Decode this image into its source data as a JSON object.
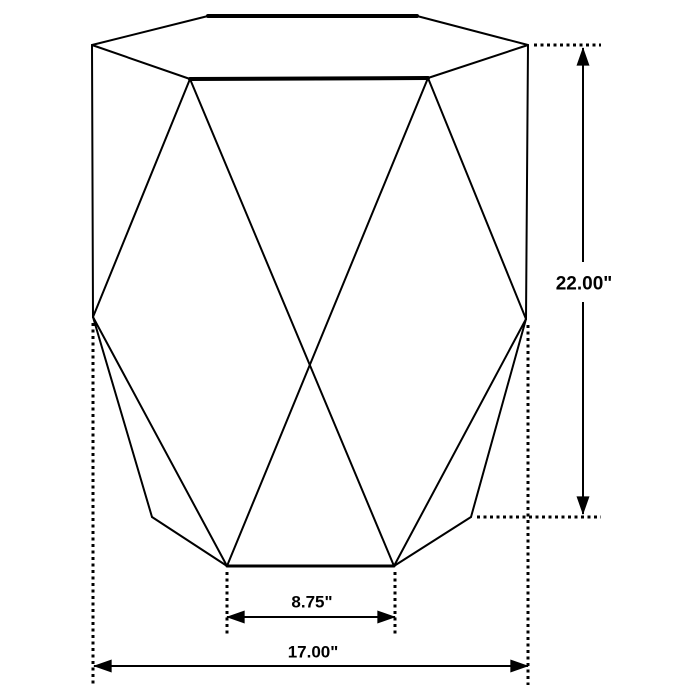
{
  "page": {
    "background": "#ffffff",
    "canvas": {
      "width": 700,
      "height": 700
    }
  },
  "diagram": {
    "description_name": "hexagonal-accent-table-dimension-drawing",
    "stroke_color": "#000000",
    "vertices": {
      "top_back_left": [
        208,
        16
      ],
      "top_back_right": [
        417,
        16
      ],
      "top_left": [
        92,
        45
      ],
      "top_right": [
        528,
        45
      ],
      "top_front_left": [
        190,
        79
      ],
      "top_front_right": [
        428,
        78
      ],
      "waist_left": [
        93,
        317
      ],
      "waist_right": [
        526,
        319
      ],
      "base_left": [
        152,
        517
      ],
      "base_right": [
        471,
        517
      ],
      "foot_left": [
        227,
        566
      ],
      "foot_right": [
        394,
        566
      ]
    },
    "edges": [
      {
        "name": "top-back-edge",
        "from": "top_back_left",
        "to": "top_back_right",
        "width": 4
      },
      {
        "name": "top-front-edge",
        "from": "top_front_left",
        "to": "top_front_right",
        "width": 4
      },
      {
        "name": "bottom-front-edge",
        "from": "foot_left",
        "to": "foot_right",
        "width": 3
      },
      {
        "name": "top-back-left-edge",
        "from": "top_back_left",
        "to": "top_left",
        "width": 2
      },
      {
        "name": "top-back-right-edge",
        "from": "top_back_right",
        "to": "top_right",
        "width": 2
      },
      {
        "name": "top-front-left-edge",
        "from": "top_left",
        "to": "top_front_left",
        "width": 2
      },
      {
        "name": "top-front-right-edge",
        "from": "top_right",
        "to": "top_front_right",
        "width": 2
      },
      {
        "name": "left-side-edge",
        "from": "top_left",
        "to": "waist_left",
        "width": 2
      },
      {
        "name": "right-side-edge",
        "from": "top_right",
        "to": "waist_right",
        "width": 2
      },
      {
        "name": "facet-upper-left",
        "from": "top_front_left",
        "to": "waist_left",
        "width": 2
      },
      {
        "name": "facet-upper-right",
        "from": "top_front_right",
        "to": "waist_right",
        "width": 2
      },
      {
        "name": "facet-diagonal-left",
        "from": "top_front_left",
        "to": "foot_right",
        "width": 2
      },
      {
        "name": "facet-diagonal-right",
        "from": "top_front_right",
        "to": "foot_left",
        "width": 2
      },
      {
        "name": "lower-silhouette-left",
        "from": "waist_left",
        "to": "base_left",
        "width": 2
      },
      {
        "name": "lower-facet-left",
        "from": "waist_left",
        "to": "foot_left",
        "width": 2
      },
      {
        "name": "lower-silhouette-right",
        "from": "waist_right",
        "to": "base_right",
        "width": 2
      },
      {
        "name": "lower-facet-right",
        "from": "waist_right",
        "to": "foot_right",
        "width": 2
      },
      {
        "name": "base-left-edge",
        "from": "base_left",
        "to": "foot_left",
        "width": 2
      },
      {
        "name": "base-right-edge",
        "from": "base_right",
        "to": "foot_right",
        "width": 2
      }
    ],
    "extension_lines": [
      {
        "name": "ext-height-top",
        "x1": 534,
        "y1": 45,
        "x2": 601,
        "y2": 45
      },
      {
        "name": "ext-height-bottom",
        "x1": 477,
        "y1": 517,
        "x2": 601,
        "y2": 517
      },
      {
        "name": "ext-width-left",
        "x1": 93,
        "y1": 323,
        "x2": 93,
        "y2": 685
      },
      {
        "name": "ext-width-right",
        "x1": 528,
        "y1": 325,
        "x2": 528,
        "y2": 685
      },
      {
        "name": "ext-base-left",
        "x1": 227,
        "y1": 572,
        "x2": 227,
        "y2": 634
      },
      {
        "name": "ext-base-right",
        "x1": 395,
        "y1": 572,
        "x2": 395,
        "y2": 634
      }
    ],
    "dimension_lines": [
      {
        "name": "dim-height-upper-segment",
        "x1": 583,
        "y1": 262,
        "x2": 583,
        "y2": 48,
        "arrows": "end"
      },
      {
        "name": "dim-height-lower-segment",
        "x1": 583,
        "y1": 302,
        "x2": 583,
        "y2": 514,
        "arrows": "end"
      },
      {
        "name": "dim-base-width-line",
        "x1": 227,
        "y1": 617,
        "x2": 395,
        "y2": 617,
        "arrows": "both"
      },
      {
        "name": "dim-total-width-line",
        "x1": 94,
        "y1": 666,
        "x2": 528,
        "y2": 666,
        "arrows": "both"
      }
    ],
    "labels": [
      {
        "name": "height-dimension-label",
        "text": "22.00\"",
        "x": 584,
        "y": 284,
        "size": 19
      },
      {
        "name": "base-width-dimension-label",
        "text": "8.75\"",
        "x": 312,
        "y": 602,
        "size": 17
      },
      {
        "name": "total-width-dimension-label",
        "text": "17.00\"",
        "x": 313,
        "y": 652,
        "size": 17
      }
    ]
  }
}
